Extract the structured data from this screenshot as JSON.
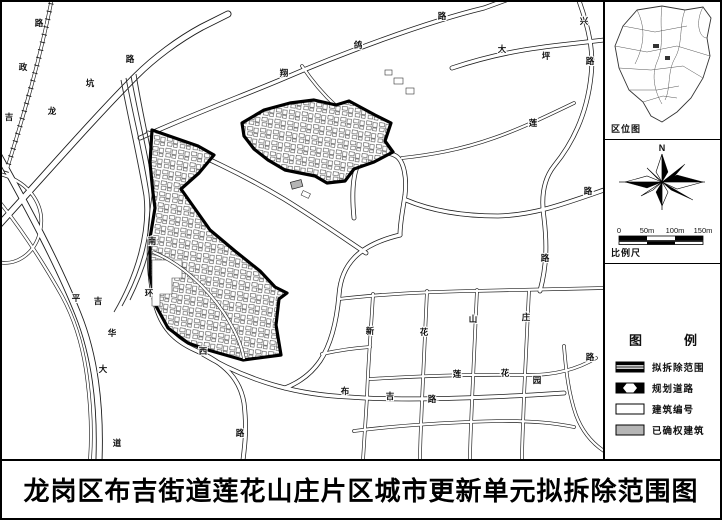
{
  "title": "龙岗区布吉街道莲花山庄片区城市更新单元拟拆除范围图",
  "sidebar": {
    "location_label": "区位图",
    "compass": {
      "north": "N"
    },
    "scale": {
      "ticks": [
        "0",
        "50m",
        "100m",
        "150m"
      ],
      "label": "比例尺"
    },
    "legend": {
      "title": "图例",
      "items": [
        {
          "symbol": "demolition-boundary",
          "label": "拟拆除范围"
        },
        {
          "symbol": "planned-road",
          "label": "规划道路"
        },
        {
          "symbol": "building-number",
          "label": "建筑编号"
        },
        {
          "symbol": "confirmed-building",
          "label": "已确权建筑"
        }
      ]
    }
  },
  "map": {
    "colors": {
      "road_casing": "#1c1c1c",
      "demolition_boundary": "#000000",
      "confirmed_building_fill": "#b5b5b5",
      "background": "#ffffff"
    },
    "road_labels": [
      {
        "t": "吉",
        "x": 7,
        "y": 118
      },
      {
        "t": "政",
        "x": 21,
        "y": 68
      },
      {
        "t": "路",
        "x": 37,
        "y": 24
      },
      {
        "t": "龙",
        "x": 50,
        "y": 112
      },
      {
        "t": "坑",
        "x": 88,
        "y": 84
      },
      {
        "t": "路",
        "x": 128,
        "y": 60
      },
      {
        "t": "翔",
        "x": 282,
        "y": 74
      },
      {
        "t": "鸽",
        "x": 356,
        "y": 46
      },
      {
        "t": "路",
        "x": 440,
        "y": 17
      },
      {
        "t": "大",
        "x": 500,
        "y": 50
      },
      {
        "t": "坪",
        "x": 544,
        "y": 57
      },
      {
        "t": "兴",
        "x": 582,
        "y": 22
      },
      {
        "t": "路",
        "x": 588,
        "y": 62
      },
      {
        "t": "莲",
        "x": 531,
        "y": 124
      },
      {
        "t": "路",
        "x": 586,
        "y": 192
      },
      {
        "t": "路",
        "x": 543,
        "y": 259
      },
      {
        "t": "南",
        "x": 150,
        "y": 242
      },
      {
        "t": "环",
        "x": 147,
        "y": 294
      },
      {
        "t": "西",
        "x": 201,
        "y": 352
      },
      {
        "t": "路",
        "x": 238,
        "y": 434
      },
      {
        "t": "平",
        "x": 74,
        "y": 299
      },
      {
        "t": "吉",
        "x": 96,
        "y": 302
      },
      {
        "t": "华",
        "x": 110,
        "y": 334
      },
      {
        "t": "大",
        "x": 101,
        "y": 370
      },
      {
        "t": "道",
        "x": 115,
        "y": 444
      },
      {
        "t": "布",
        "x": 343,
        "y": 392
      },
      {
        "t": "吉",
        "x": 388,
        "y": 397
      },
      {
        "t": "路",
        "x": 430,
        "y": 400
      },
      {
        "t": "莲",
        "x": 455,
        "y": 375
      },
      {
        "t": "花",
        "x": 503,
        "y": 374
      },
      {
        "t": "园",
        "x": 535,
        "y": 381
      },
      {
        "t": "路",
        "x": 588,
        "y": 358
      },
      {
        "t": "新",
        "x": 368,
        "y": 332
      },
      {
        "t": "花",
        "x": 422,
        "y": 333
      },
      {
        "t": "山",
        "x": 471,
        "y": 320
      },
      {
        "t": "庄",
        "x": 524,
        "y": 318
      }
    ]
  }
}
